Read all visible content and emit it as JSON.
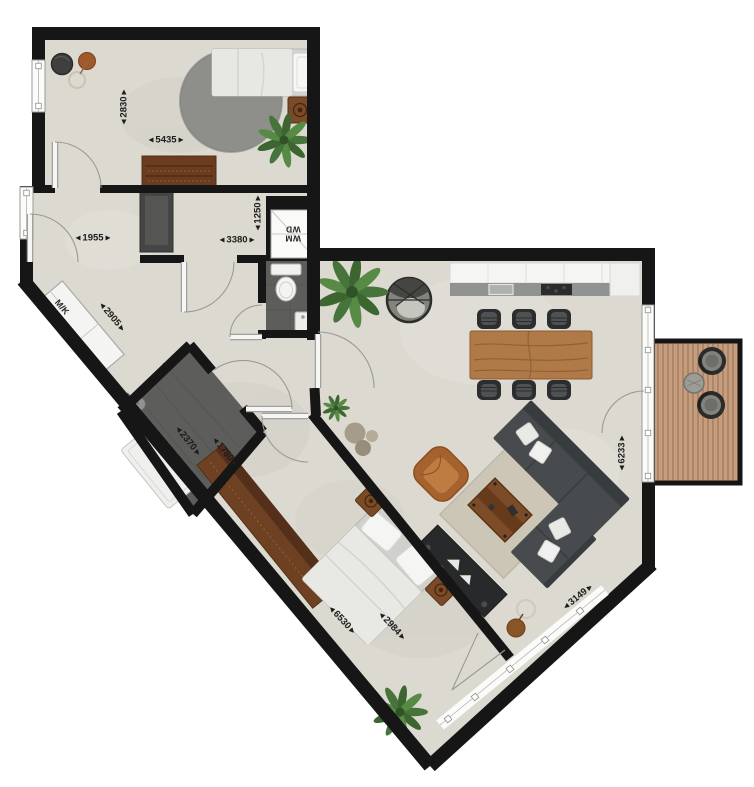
{
  "floorplan": {
    "unit": "mm",
    "labels": {
      "meter_cabinet": "M/K",
      "washer": "WM",
      "dryer": "WD"
    },
    "arrows": {
      "left": "◀",
      "right": "▶"
    },
    "dimensions": {
      "bedroom1_depth": "2830",
      "bedroom1_width": "5435",
      "hall_width": "1955",
      "corridor_length": "3380",
      "washer_closet": "1250",
      "entrance_wall": "2905",
      "bathroom_width": "2370",
      "bathroom_length": "1780",
      "bedroom2_length": "6530",
      "bedroom2_width": "2984",
      "living_room_depth": "6233",
      "living_window_width": "3149"
    },
    "colors": {
      "wall": "#161616",
      "floor": "#dcd9d0",
      "wet_room_floor": "#5d5d5b",
      "wood_dark": "#6e4123",
      "wood_mid": "#b07a48",
      "deck": "#c69e7e",
      "sofa": "#484b4d",
      "plant": "#47743a",
      "accent_chair": "#a5622e"
    }
  }
}
